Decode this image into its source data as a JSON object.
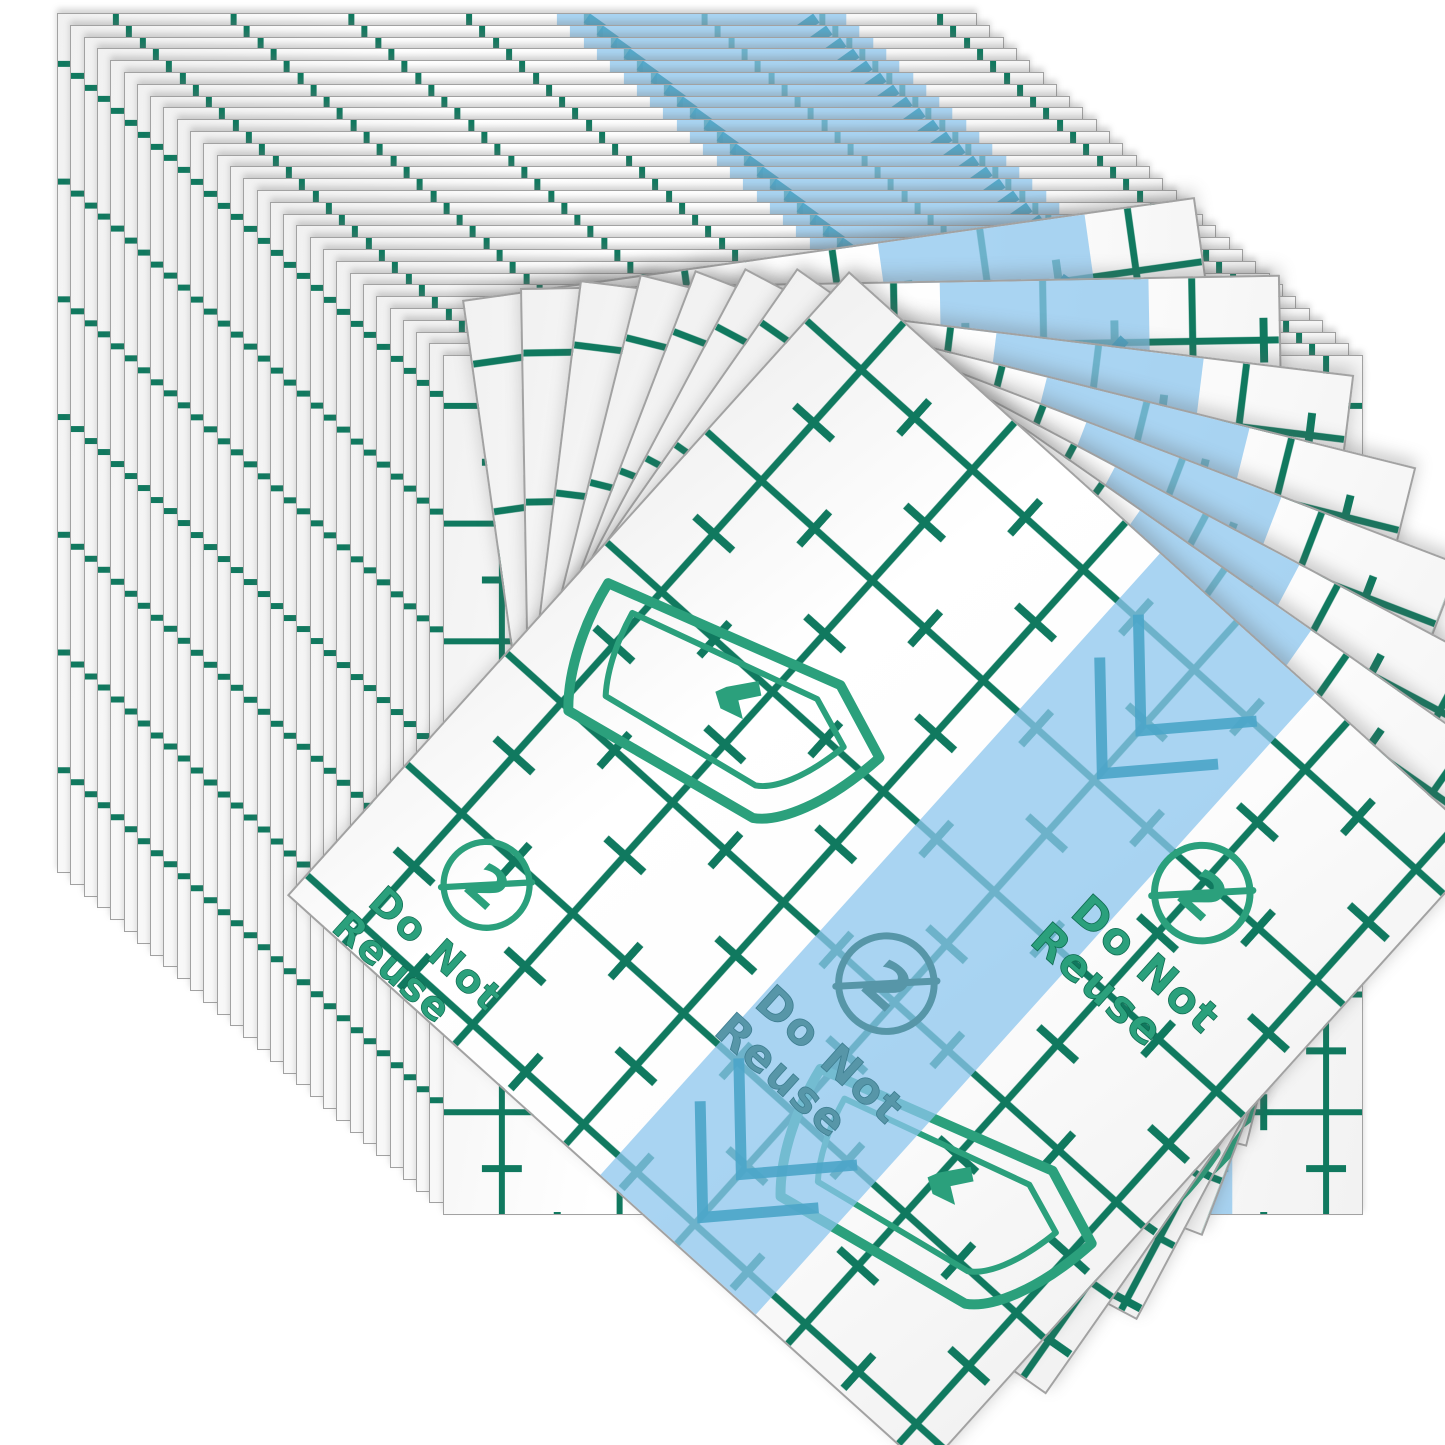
{
  "image_type": "product-photo",
  "product": {
    "name": "transfer-film-sheets",
    "stamp": {
      "line1": "Do Not",
      "line2": "Reuse",
      "symbol_digit": "2",
      "symbol": "do-not-reuse-icon"
    },
    "icons": [
      "peel-corner-icon",
      "do-not-reuse-icon",
      "stripe-chevron-icon"
    ],
    "back_stack_count": 30,
    "fan_count": 8
  },
  "colors": {
    "background": "#ffffff",
    "grid_green": "#10795f",
    "stamp_green": "#2ba07c",
    "stamp_green_dark": "#0e6b50",
    "stamp_muted": "#5796a8",
    "stamp_muted_dark": "#3d7d90",
    "stripe_blue": "#8cc6ee",
    "chevron_blue": "#4da6c9",
    "sheet_edge_gray": "#a2a2a2"
  }
}
